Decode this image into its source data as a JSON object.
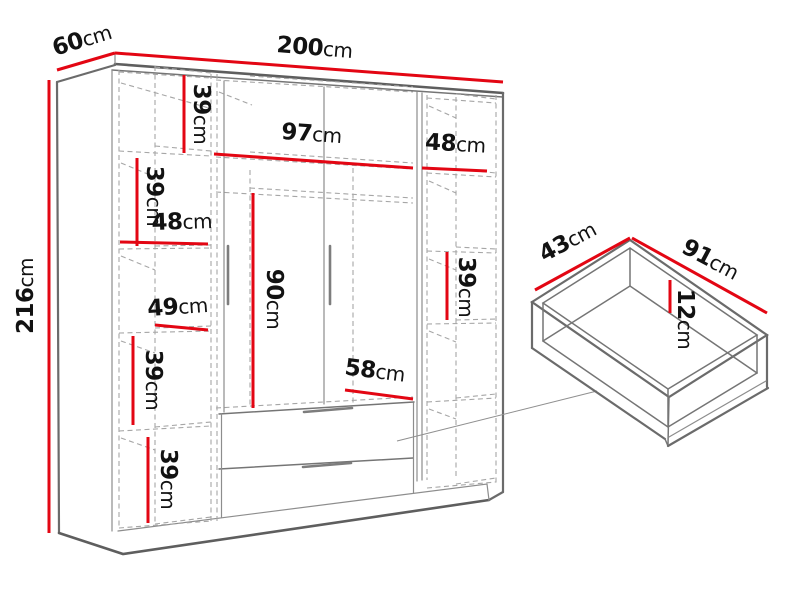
{
  "figure": {
    "kind": "wardrobe-dimension-diagram",
    "accent_color": "#e30613",
    "outline_color": "#6b6b6b",
    "background_color": "#ffffff"
  },
  "wardrobe": {
    "width": {
      "v": "200",
      "u": "cm"
    },
    "depth": {
      "v": "60",
      "u": "cm"
    },
    "height": {
      "v": "216",
      "u": "cm"
    },
    "left_column": {
      "top_shelf_height": {
        "v": "39",
        "u": "cm"
      },
      "second_shelf_height": {
        "v": "39",
        "u": "cm"
      },
      "shelf_width": {
        "v": "48",
        "u": "cm"
      },
      "lower_shelf_width": {
        "v": "49",
        "u": "cm"
      },
      "third_shelf_height": {
        "v": "39",
        "u": "cm"
      },
      "bottom_shelf_height": {
        "v": "39",
        "u": "cm"
      }
    },
    "center_section": {
      "width": {
        "v": "97",
        "u": "cm"
      },
      "hanging_height": {
        "v": "90",
        "u": "cm"
      },
      "drawer_width": {
        "v": "58",
        "u": "cm"
      }
    },
    "right_column": {
      "width": {
        "v": "48",
        "u": "cm"
      },
      "shelf_height": {
        "v": "39",
        "u": "cm"
      }
    }
  },
  "drawer": {
    "depth": {
      "v": "43",
      "u": "cm"
    },
    "width": {
      "v": "91",
      "u": "cm"
    },
    "height": {
      "v": "12",
      "u": "cm"
    }
  }
}
